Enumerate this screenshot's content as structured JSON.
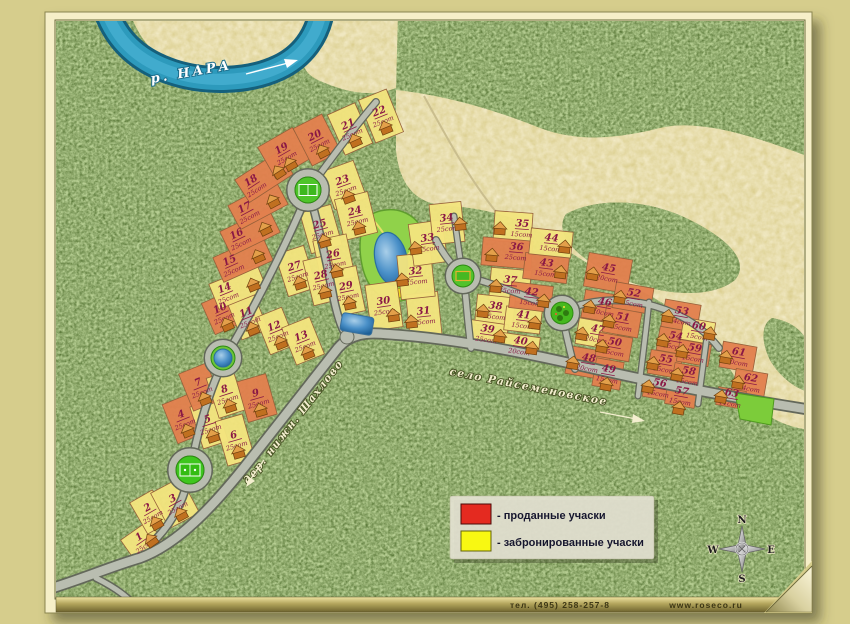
{
  "river_label": "р. НАРА",
  "road_labels": {
    "left": "дер. нижн. Шахлово",
    "right": "село Райсеменовское"
  },
  "legend": {
    "sold": "- проданные учаски",
    "reserved": "- забронированные учаски"
  },
  "compass": {
    "n": "N",
    "w": "W",
    "e": "E",
    "s": "S"
  },
  "footer": {
    "phone": "тел. (495) 258-257-8",
    "site": "www.roseco.ru"
  },
  "colors": {
    "sold_fill": "#e2804e",
    "reserved_fill": "#f2e47e",
    "legend_sold": "#e42a20",
    "legend_reserved": "#f8f812",
    "label": "#8a1845",
    "water": "#2d9abc"
  },
  "plots": [
    {
      "n": 1,
      "area": "25сот",
      "status": "reserved"
    },
    {
      "n": 2,
      "area": "25сот",
      "status": "reserved"
    },
    {
      "n": 3,
      "area": "25сот",
      "status": "reserved"
    },
    {
      "n": 4,
      "area": "25сот",
      "status": "sold"
    },
    {
      "n": 5,
      "area": "25сот",
      "status": "reserved"
    },
    {
      "n": 6,
      "area": "25сот",
      "status": "reserved"
    },
    {
      "n": 7,
      "area": "25сот",
      "status": "sold"
    },
    {
      "n": 8,
      "area": "25сот",
      "status": "reserved"
    },
    {
      "n": 9,
      "area": "25сот",
      "status": "sold"
    },
    {
      "n": 10,
      "area": "25сот",
      "status": "sold"
    },
    {
      "n": 11,
      "area": "25сот",
      "status": "reserved"
    },
    {
      "n": 12,
      "area": "25сот",
      "status": "reserved"
    },
    {
      "n": 13,
      "area": "25сот",
      "status": "reserved"
    },
    {
      "n": 14,
      "area": "25сот",
      "status": "reserved"
    },
    {
      "n": 15,
      "area": "25сот",
      "status": "sold"
    },
    {
      "n": 16,
      "area": "25сот",
      "status": "sold"
    },
    {
      "n": 17,
      "area": "25сот",
      "status": "sold"
    },
    {
      "n": 18,
      "area": "25сот",
      "status": "sold"
    },
    {
      "n": 19,
      "area": "25сот",
      "status": "sold"
    },
    {
      "n": 20,
      "area": "25сот",
      "status": "sold"
    },
    {
      "n": 21,
      "area": "25сот",
      "status": "reserved"
    },
    {
      "n": 22,
      "area": "25сот",
      "status": "reserved"
    },
    {
      "n": 23,
      "area": "25сот",
      "status": "reserved"
    },
    {
      "n": 24,
      "area": "25сот",
      "status": "reserved"
    },
    {
      "n": 25,
      "area": "25сот",
      "status": "reserved"
    },
    {
      "n": 26,
      "area": "25сот",
      "status": "reserved"
    },
    {
      "n": 27,
      "area": "25сот",
      "status": "reserved"
    },
    {
      "n": 28,
      "area": "25сот",
      "status": "reserved"
    },
    {
      "n": 29,
      "area": "25сот",
      "status": "reserved"
    },
    {
      "n": 30,
      "area": "25сот",
      "status": "reserved"
    },
    {
      "n": 31,
      "area": "25сот",
      "status": "reserved"
    },
    {
      "n": 32,
      "area": "25сот",
      "status": "reserved"
    },
    {
      "n": 33,
      "area": "25сот",
      "status": "reserved"
    },
    {
      "n": 34,
      "area": "25сот",
      "status": "reserved"
    },
    {
      "n": 35,
      "area": "15сот",
      "status": "reserved"
    },
    {
      "n": 36,
      "area": "25сот",
      "status": "sold"
    },
    {
      "n": 37,
      "area": "25сот",
      "status": "reserved"
    },
    {
      "n": 38,
      "area": "25сот",
      "status": "reserved"
    },
    {
      "n": 39,
      "area": "25сот",
      "status": "reserved"
    },
    {
      "n": 40,
      "area": "20сот",
      "status": "reserved"
    },
    {
      "n": 41,
      "area": "15сот",
      "status": "reserved"
    },
    {
      "n": 42,
      "area": "15сот",
      "status": "sold"
    },
    {
      "n": 43,
      "area": "15сот",
      "status": "sold"
    },
    {
      "n": 44,
      "area": "15сот",
      "status": "reserved"
    },
    {
      "n": 45,
      "area": "20сот",
      "status": "sold"
    },
    {
      "n": 46,
      "area": "20сот",
      "status": "sold"
    },
    {
      "n": 47,
      "area": "20сот",
      "status": "reserved"
    },
    {
      "n": 48,
      "area": "20сот",
      "status": "sold"
    },
    {
      "n": 49,
      "area": "15сот",
      "status": "sold"
    },
    {
      "n": 50,
      "area": "15сот",
      "status": "sold"
    },
    {
      "n": 51,
      "area": "15сот",
      "status": "sold"
    },
    {
      "n": 52,
      "area": "15сот",
      "status": "sold"
    },
    {
      "n": 53,
      "area": "14сот",
      "status": "sold"
    },
    {
      "n": 54,
      "area": "15сот",
      "status": "sold"
    },
    {
      "n": 55,
      "area": "15сот",
      "status": "sold"
    },
    {
      "n": 56,
      "area": "15сот",
      "status": "sold"
    },
    {
      "n": 57,
      "area": "15сот",
      "status": "sold"
    },
    {
      "n": 58,
      "area": "15сот",
      "status": "sold"
    },
    {
      "n": 59,
      "area": "15сот",
      "status": "sold"
    },
    {
      "n": 60,
      "area": "15сот",
      "status": "reserved"
    },
    {
      "n": 61,
      "area": "20сот",
      "status": "sold"
    },
    {
      "n": 62,
      "area": "14сот",
      "status": "sold"
    },
    {
      "n": 63,
      "area": "11сот",
      "status": "sold"
    }
  ]
}
